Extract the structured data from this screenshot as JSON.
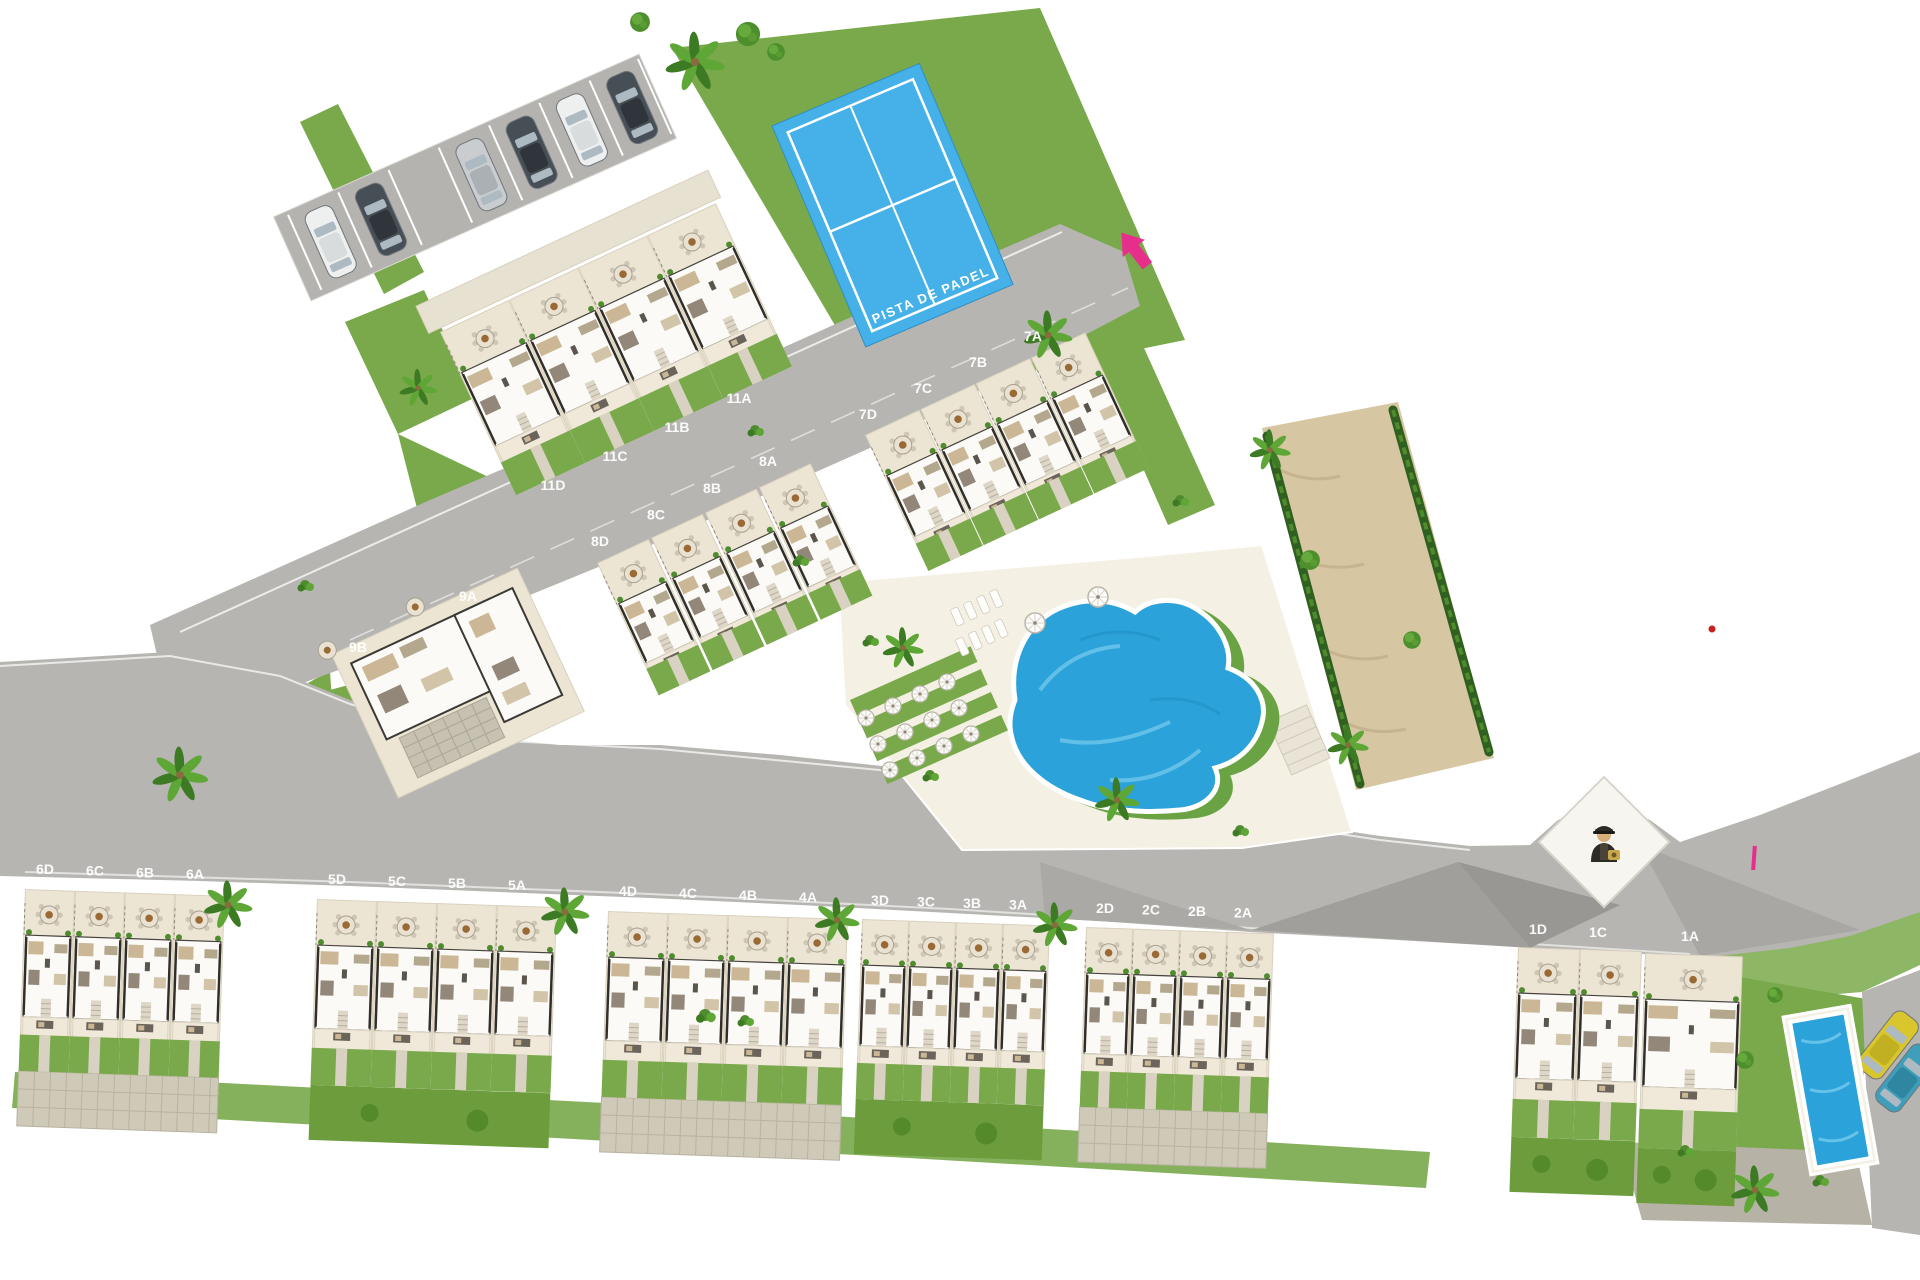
{
  "padel": {
    "label": "PISTA DE PADEL"
  },
  "units": {
    "row11": [
      "11D",
      "11C",
      "11B",
      "11A"
    ],
    "row7": [
      "7D",
      "7C",
      "7B",
      "7A"
    ],
    "row8": [
      "8D",
      "8C",
      "8B",
      "8A"
    ],
    "row9": [
      "9B",
      "9A"
    ],
    "bottom": [
      [
        "6D",
        "6C",
        "6B",
        "6A"
      ],
      [
        "5D",
        "5C",
        "5B",
        "5A"
      ],
      [
        "4D",
        "4C",
        "4B",
        "4A"
      ],
      [
        "3D",
        "3C",
        "3B",
        "3A"
      ],
      [
        "2D",
        "2C",
        "2B",
        "2A"
      ],
      [
        "1D",
        "1C"
      ],
      [
        "1A"
      ]
    ]
  },
  "icons": {
    "entrance_arrow": "pink-entrance-arrow-icon",
    "security_guard": "security-guard-icon",
    "palm_tree": "palm-tree-icon",
    "car": "car-top-view-icon",
    "patio_table": "round-patio-table-icon",
    "parasol": "parasol-icon"
  },
  "colors": {
    "background": "#ffffff",
    "road": "#b6b5b1",
    "road_dark": "#a09f9b",
    "grass": "#79a94a",
    "grass_dark": "#4f7d28",
    "hedge": "#2f6020",
    "plot": "#ece5d3",
    "plot_line": "#d9d1bd",
    "house": "#fbfaf6",
    "house_wall": "#45433d",
    "pool_blue": "#2ba3da",
    "pool_light": "#7fd0ef",
    "padel_blue": "#45b1e8",
    "sand": "#d6c6a2",
    "paved": "#cfc9b8",
    "accent_pink": "#e62e8b",
    "car_yellow": "#d8c62c",
    "car_teal": "#3f9fba"
  }
}
